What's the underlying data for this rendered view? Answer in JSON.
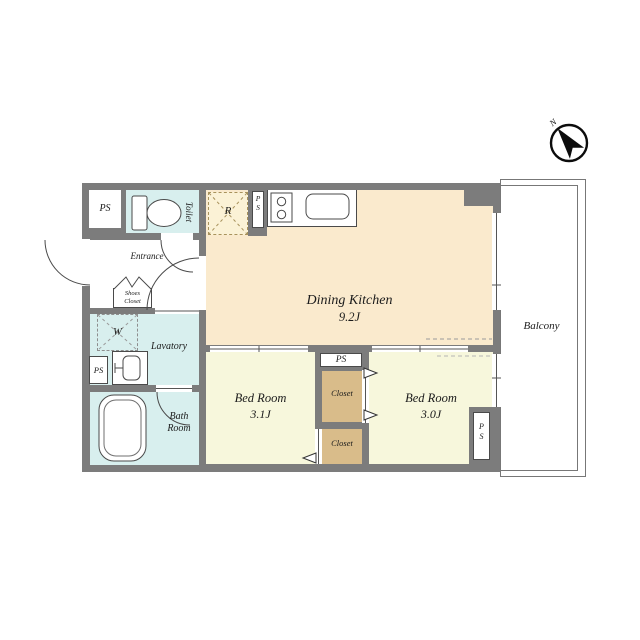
{
  "colors": {
    "wall": "#7c7c7c",
    "dining_kitchen": "#faeacd",
    "bedroom": "#f7f7dc",
    "wet_area": "#d8efee",
    "closet": "#d9bc8a",
    "fridge_box": "#fbf2d6"
  },
  "rooms": {
    "dining_kitchen": {
      "label": "Dining Kitchen",
      "size": "9.2J"
    },
    "bedroom1": {
      "label": "Bed Room",
      "size": "3.1J"
    },
    "bedroom2": {
      "label": "Bed Room",
      "size": "3.0J"
    },
    "toilet": {
      "label": "Toilet"
    },
    "entrance": {
      "label": "Entrance"
    },
    "shoes_closet": {
      "line1": "Shoes",
      "line2": "Closet"
    },
    "lavatory": {
      "label": "Lavatory"
    },
    "bathroom": {
      "line1": "Bath",
      "line2": "Room"
    },
    "closet_upper": {
      "label": "Closet"
    },
    "closet_lower": {
      "label": "Closet"
    },
    "balcony": {
      "label": "Balcony"
    }
  },
  "fixtures": {
    "washer_label": "W",
    "fridge_label": "R"
  },
  "pipe_space": {
    "label": "PS",
    "p": "P",
    "s": "S"
  },
  "compass": {
    "north_label": "N"
  }
}
